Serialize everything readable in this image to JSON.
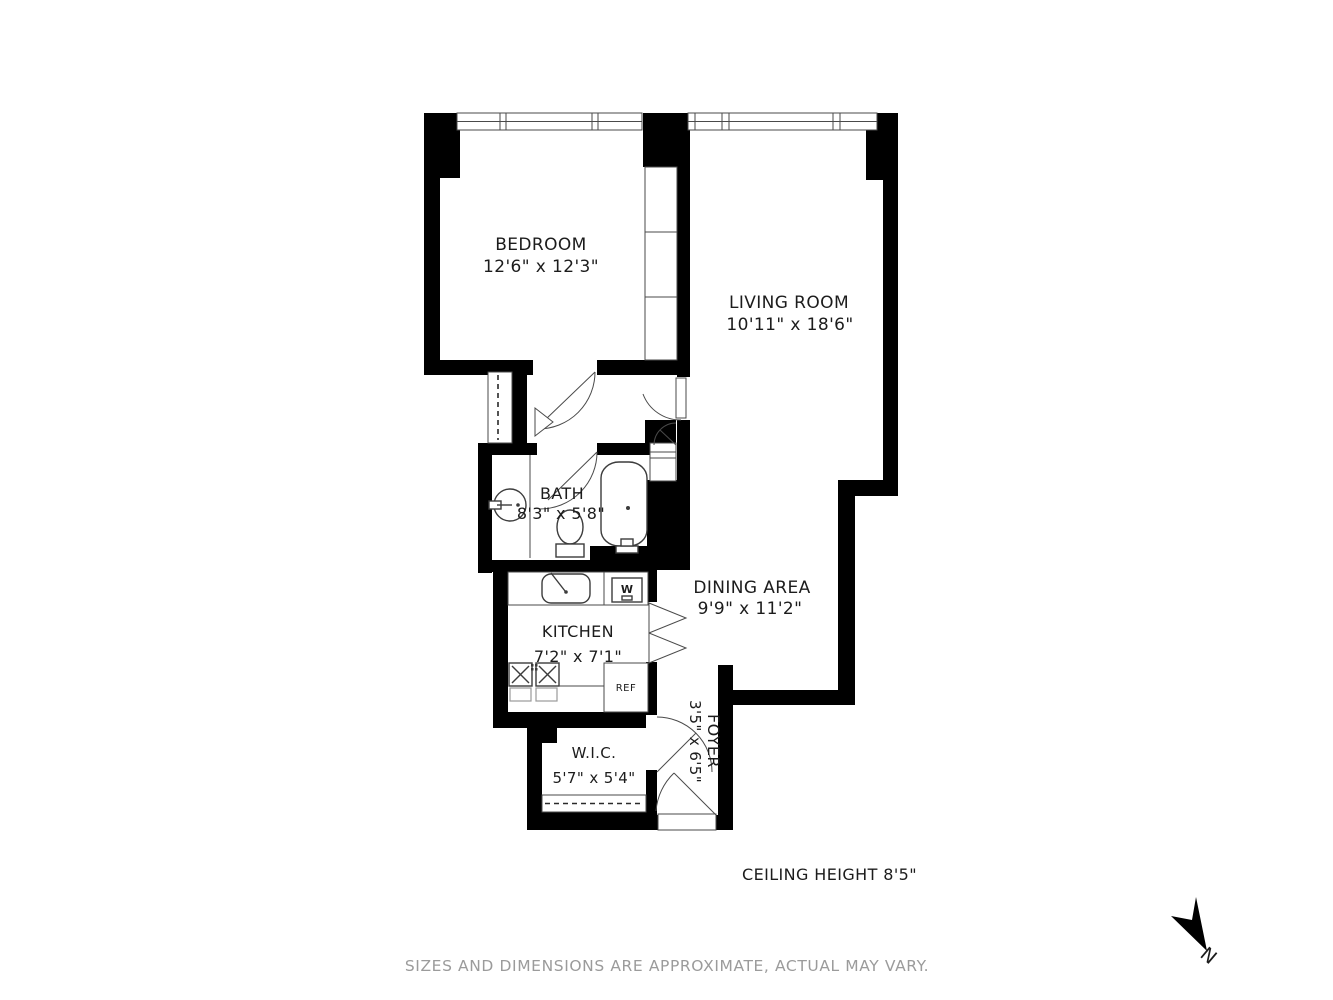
{
  "title": "apartment-floor-plan",
  "rooms": {
    "bedroom": {
      "label": "BEDROOM",
      "dims": "12'6\" x 12'3\""
    },
    "living": {
      "label": "LIVING ROOM",
      "dims": "10'11\" x 18'6\""
    },
    "bath": {
      "label": "BATH",
      "dims": "8'3\" x 5'8\""
    },
    "dining": {
      "label": "DINING AREA",
      "dims": "9'9\" x 11'2\""
    },
    "kitchen": {
      "label": "KITCHEN",
      "dims": "7'2\" x 7'1\""
    },
    "wic": {
      "label": "W.I.C.",
      "dims": "5'7\" x 5'4\""
    },
    "foyer": {
      "label": "FOYER",
      "dims": "3'5\" x 6'5\""
    }
  },
  "appliances": {
    "washer_label": "W",
    "fridge_label": "REF"
  },
  "notes": {
    "ceiling": "CEILING HEIGHT 8'5\"",
    "disclaimer": "SIZES AND DIMENSIONS ARE APPROXIMATE, ACTUAL MAY VARY."
  },
  "compass": {
    "north_label": "N"
  },
  "colors": {
    "wall": "#000000",
    "fixture_line": "#3c3c3c",
    "text": "#1c1c1c",
    "muted_text": "#9b9b9b",
    "background": "#ffffff"
  }
}
